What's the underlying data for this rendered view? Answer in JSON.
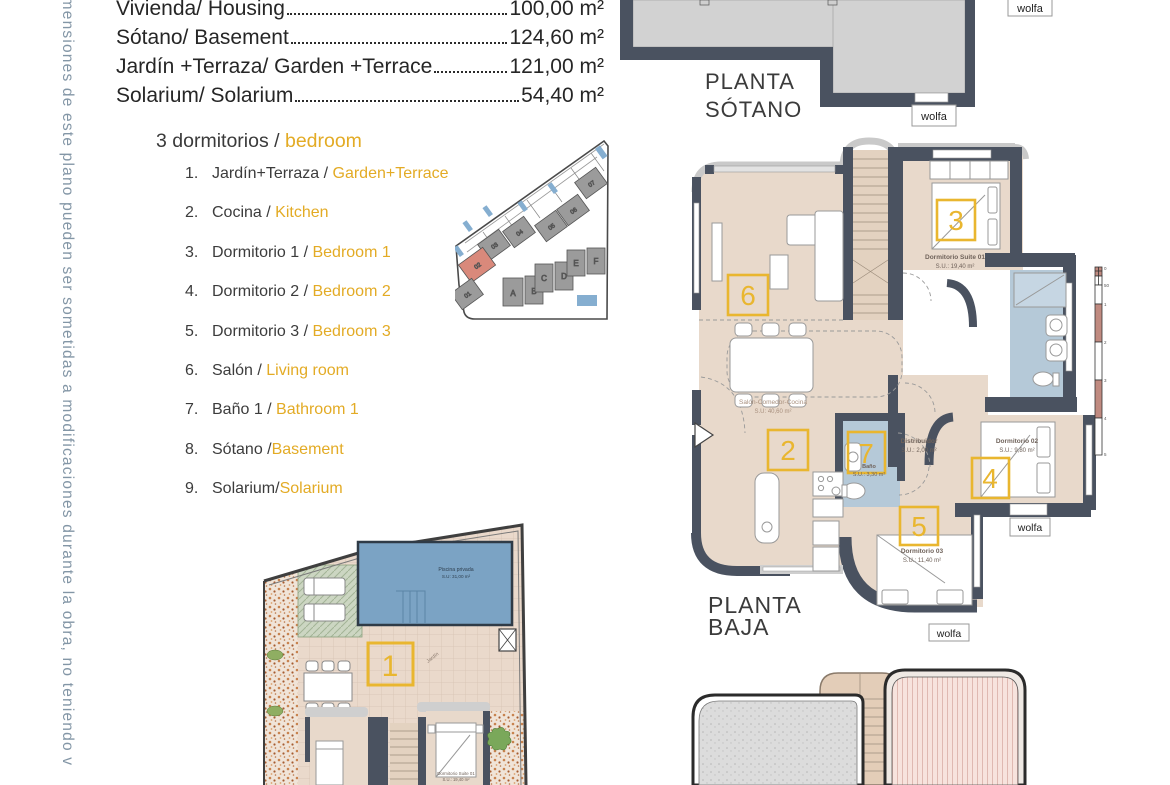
{
  "side_note": "imensiones de este plano pueden ser sometidas a modificaciones durante la obra, no teniendo v",
  "areas": {
    "rows": [
      {
        "label": "Vivienda/ Housing",
        "value": "100,00 m²"
      },
      {
        "label": "Sótano/ Basement",
        "value": "124,60 m²"
      },
      {
        "label": "Jardín +Terraza/ Garden +Terrace",
        "value": "121,00 m²"
      },
      {
        "label": "Solarium/ Solarium",
        "value": "54,40 m²"
      }
    ]
  },
  "legend": {
    "heading_es": "3 dormitorios / ",
    "heading_en": "bedroom",
    "items": [
      {
        "num": "1.",
        "es": "Jardín+Terraza / ",
        "en": "Garden+Terrace"
      },
      {
        "num": "2.",
        "es": "Cocina / ",
        "en": "Kitchen"
      },
      {
        "num": "3.",
        "es": "Dormitorio 1 / ",
        "en": "Bedroom 1"
      },
      {
        "num": "4.",
        "es": "Dormitorio 2 / ",
        "en": "Bedroom 2"
      },
      {
        "num": "5.",
        "es": "Dormitorio 3 / ",
        "en": "Bedroom 3"
      },
      {
        "num": "6.",
        "es": "Salón / ",
        "en": "Living room"
      },
      {
        "num": "7.",
        "es": "Baño 1 / ",
        "en": "Bathroom 1"
      },
      {
        "num": "8.",
        "es": "Sótano /",
        "en": "Basement"
      },
      {
        "num": "9.",
        "es": "Solarium/",
        "en": "Solarium"
      }
    ]
  },
  "site_map": {
    "plots": [
      "01",
      "02",
      "03",
      "04",
      "05",
      "06",
      "07"
    ],
    "houses": [
      "A",
      "B",
      "C",
      "D",
      "E",
      "F"
    ],
    "highlighted_plot": "02",
    "highlight_color": "#d9897b"
  },
  "plan_sotano": {
    "title1": "PLANTA",
    "title2": "SÓTANO",
    "wolfa_top": "wolfa",
    "wolfa_bottom": "wolfa"
  },
  "plan_baja": {
    "title1": "PLANTA",
    "title2": "BAJA",
    "room6_num": "6",
    "room3_num": "3",
    "room3_name": "Dormitorio Suite 01",
    "room3_area": "S.U.: 19,40 m²",
    "salon_name": "Salón-Comedor-Cocina",
    "salon_area": "S.U: 40,60 m²",
    "room2_num": "2",
    "room7_num": "7",
    "room7_name": "Baño",
    "room7_area": "S.U.: 3,30 m²",
    "distribuidor_name": "Distribuidor",
    "distribuidor_area": "S.U.: 2,00 m²",
    "room4_num": "4",
    "room4_name": "Dormitorio 02",
    "room4_area": "S.U.: 9,80 m²",
    "room5_num": "5",
    "room5_name": "Dormitorio 03",
    "room5_area": "S.U.: 11,40 m²",
    "wolfa_right": "wolfa",
    "wolfa_bottom": "wolfa",
    "scale": {
      "t0": "0",
      "t50": "50",
      "t1": "1",
      "t2": "2",
      "t3": "3",
      "t4": "4",
      "t5": "5"
    }
  },
  "plan_garden": {
    "room1_num": "1",
    "pool_name": "Piscina privada",
    "pool_area": "S.U: 31,00 m²",
    "jardin_label": "Jardín",
    "suite_name": "Dormitorio Suite 01",
    "suite_area": "S.U.: 19,40 m²"
  },
  "colors": {
    "wall": "#4a5260",
    "floor": "#e8d9cb",
    "bath": "#b5c9d8",
    "pool": "#7ba3c4",
    "accent_yellow": "#e9b62f"
  }
}
